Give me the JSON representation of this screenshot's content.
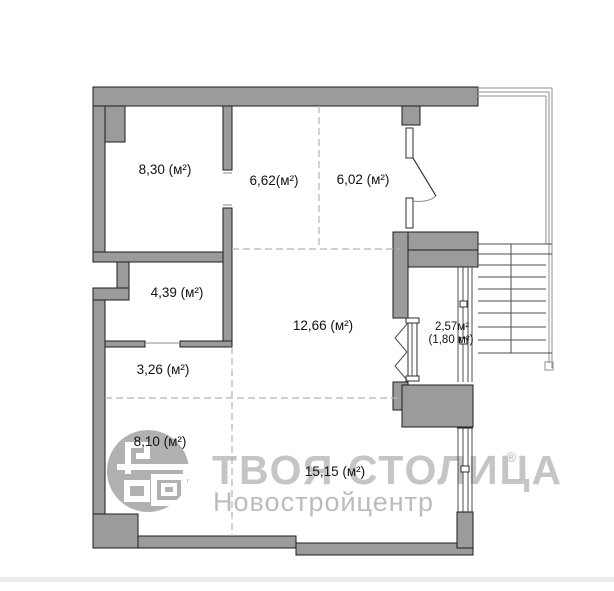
{
  "watermark": {
    "brand": "ТВОЯ СТОЛИЦА",
    "registered": "®",
    "subtitle": "Новостройцентр"
  },
  "rooms": [
    {
      "label": "8,30 (м²)"
    },
    {
      "label": "6,62(м²)"
    },
    {
      "label": "6,02 (м²)"
    },
    {
      "label": "4,39 (м²)"
    },
    {
      "label": "12,66 (м²)"
    },
    {
      "label": "3,26 (м²)"
    },
    {
      "label": "2,57м²",
      "sub": "(1,80 м²)"
    },
    {
      "label": "8,10 (м²)"
    },
    {
      "label": "15,15 (м²)"
    }
  ],
  "colors": {
    "wall_fill": "#9b9b9b",
    "wall_stroke": "#1d1d1d",
    "dash_color": "#b4b4b4",
    "thin_line": "#4d4d4d",
    "landing_line": "#8f8f8f",
    "watermark_color": "#c5c5c5",
    "watermark_sub_color": "#bcbcbc",
    "logo_circle": "#aaaaaa",
    "label_color": "#121212",
    "footer_strip": "#ededf0"
  }
}
